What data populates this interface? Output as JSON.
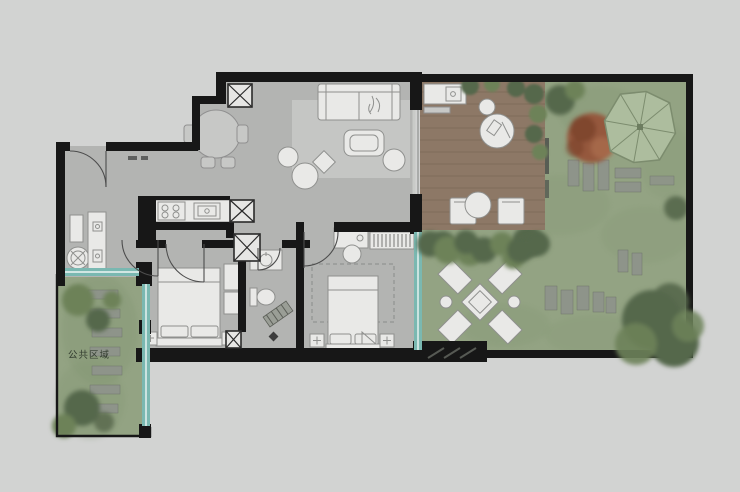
{
  "title": "residential-floor-plan-with-garden",
  "labels": {
    "public_area": "公共区域"
  },
  "colors": {
    "background": "#d2d3d2",
    "floor": "#b3b4b2",
    "floor_light": "#c5c6c4",
    "wall": "#171717",
    "furniture_fill": "#e9e9e7",
    "furniture_line": "#8f908e",
    "deck_wood": "#8d7866",
    "deck_line": "#7b6856",
    "lawn": "#93a383",
    "lawn_dark": "#7e926e",
    "tree_dark": "#55674b",
    "tree_mid": "#6d8259",
    "red_tree": "#95583e",
    "red_tree_dark": "#7b432c",
    "umbrella": "#adbd9e",
    "umbrella_line": "#7c8c6e",
    "window_teal": "#7ab8b1",
    "stone": "#8e948a",
    "label_text": "#333d30"
  },
  "plan": {
    "rooms": [
      "entry",
      "dining-area",
      "living-room",
      "kitchen",
      "hallway",
      "bathroom",
      "bedroom-1",
      "bedroom-2",
      "laundry-nook",
      "deck-terrace",
      "garden",
      "public-green-area"
    ],
    "indoor_features": [
      "entry-door",
      "round-dining-table-with-4-chairs",
      "service-shafts",
      "kitchen-counter-stove-sink",
      "washing-machine",
      "storage-island",
      "sofa",
      "coffee-table",
      "armchair",
      "poufs",
      "area-rug",
      "double-bed-1",
      "double-bed-2",
      "nightstands",
      "wardrobe-with-hangers",
      "desk-and-chair",
      "bathroom-vanity",
      "toilet"
    ],
    "outdoor_features": [
      "wood-deck",
      "outdoor-counter-with-sink",
      "bistro-table",
      "deck-chairs",
      "parasol-umbrella",
      "red-foliage-tree",
      "sun-lounger-set-with-square-table",
      "stepping-stones",
      "garden-benches",
      "hedges",
      "trees",
      "glazed-window-strips"
    ]
  }
}
